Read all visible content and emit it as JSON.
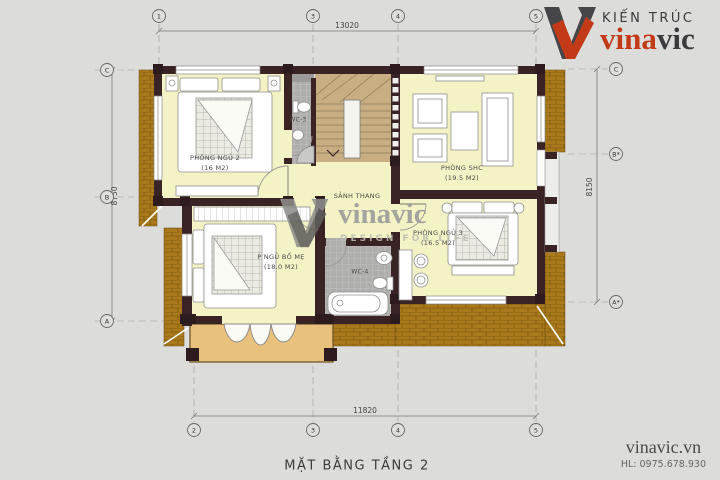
{
  "header_logo": {
    "tagline": "KIẾN TRÚC",
    "brand_prefix": "vina",
    "brand_suffix": "vic"
  },
  "watermark": {
    "brand": "vinavic",
    "tagline": "DESIGN FOR LIFE"
  },
  "footer": {
    "website": "vinavic.vn",
    "hotline": "HL: 0975.678.930"
  },
  "drawing": {
    "title": "MẶT BẰNG TẦNG 2",
    "dimensions": {
      "top": "13020",
      "bottom": "11820",
      "left": "8750",
      "right": "8150"
    },
    "grid": {
      "top": [
        "1",
        "3",
        "4",
        "5"
      ],
      "bottom": [
        "2",
        "3",
        "4",
        "5"
      ],
      "left": [
        "C",
        "B",
        "A"
      ],
      "right": [
        "C",
        "B*",
        "A*"
      ]
    },
    "rooms": [
      {
        "name": "PHÒNG NGỦ 2",
        "area": "(16 M2)"
      },
      {
        "name": "PHÒNG SHC",
        "area": "(19.5 M2)"
      },
      {
        "name": "SẢNH THANG",
        "area": ""
      },
      {
        "name": "P NGỦ BỐ MẸ",
        "area": "(18.0 M2)"
      },
      {
        "name": "PHÒNG NGỦ 3",
        "area": "(16.5 M2)"
      },
      {
        "name": "WC-3",
        "area": ""
      },
      {
        "name": "WC-4",
        "area": ""
      }
    ],
    "colors": {
      "background": "#DCDCDA",
      "room_fill": "#F3F3C5",
      "roof": "#A9791B",
      "wall": "#3A2325",
      "stair": "#C9AE83",
      "balcony": "#E8C17D",
      "wc_tile": "#AEAEAC",
      "brand_red": "#C23A18",
      "brand_dark": "#3B3B3D"
    }
  }
}
